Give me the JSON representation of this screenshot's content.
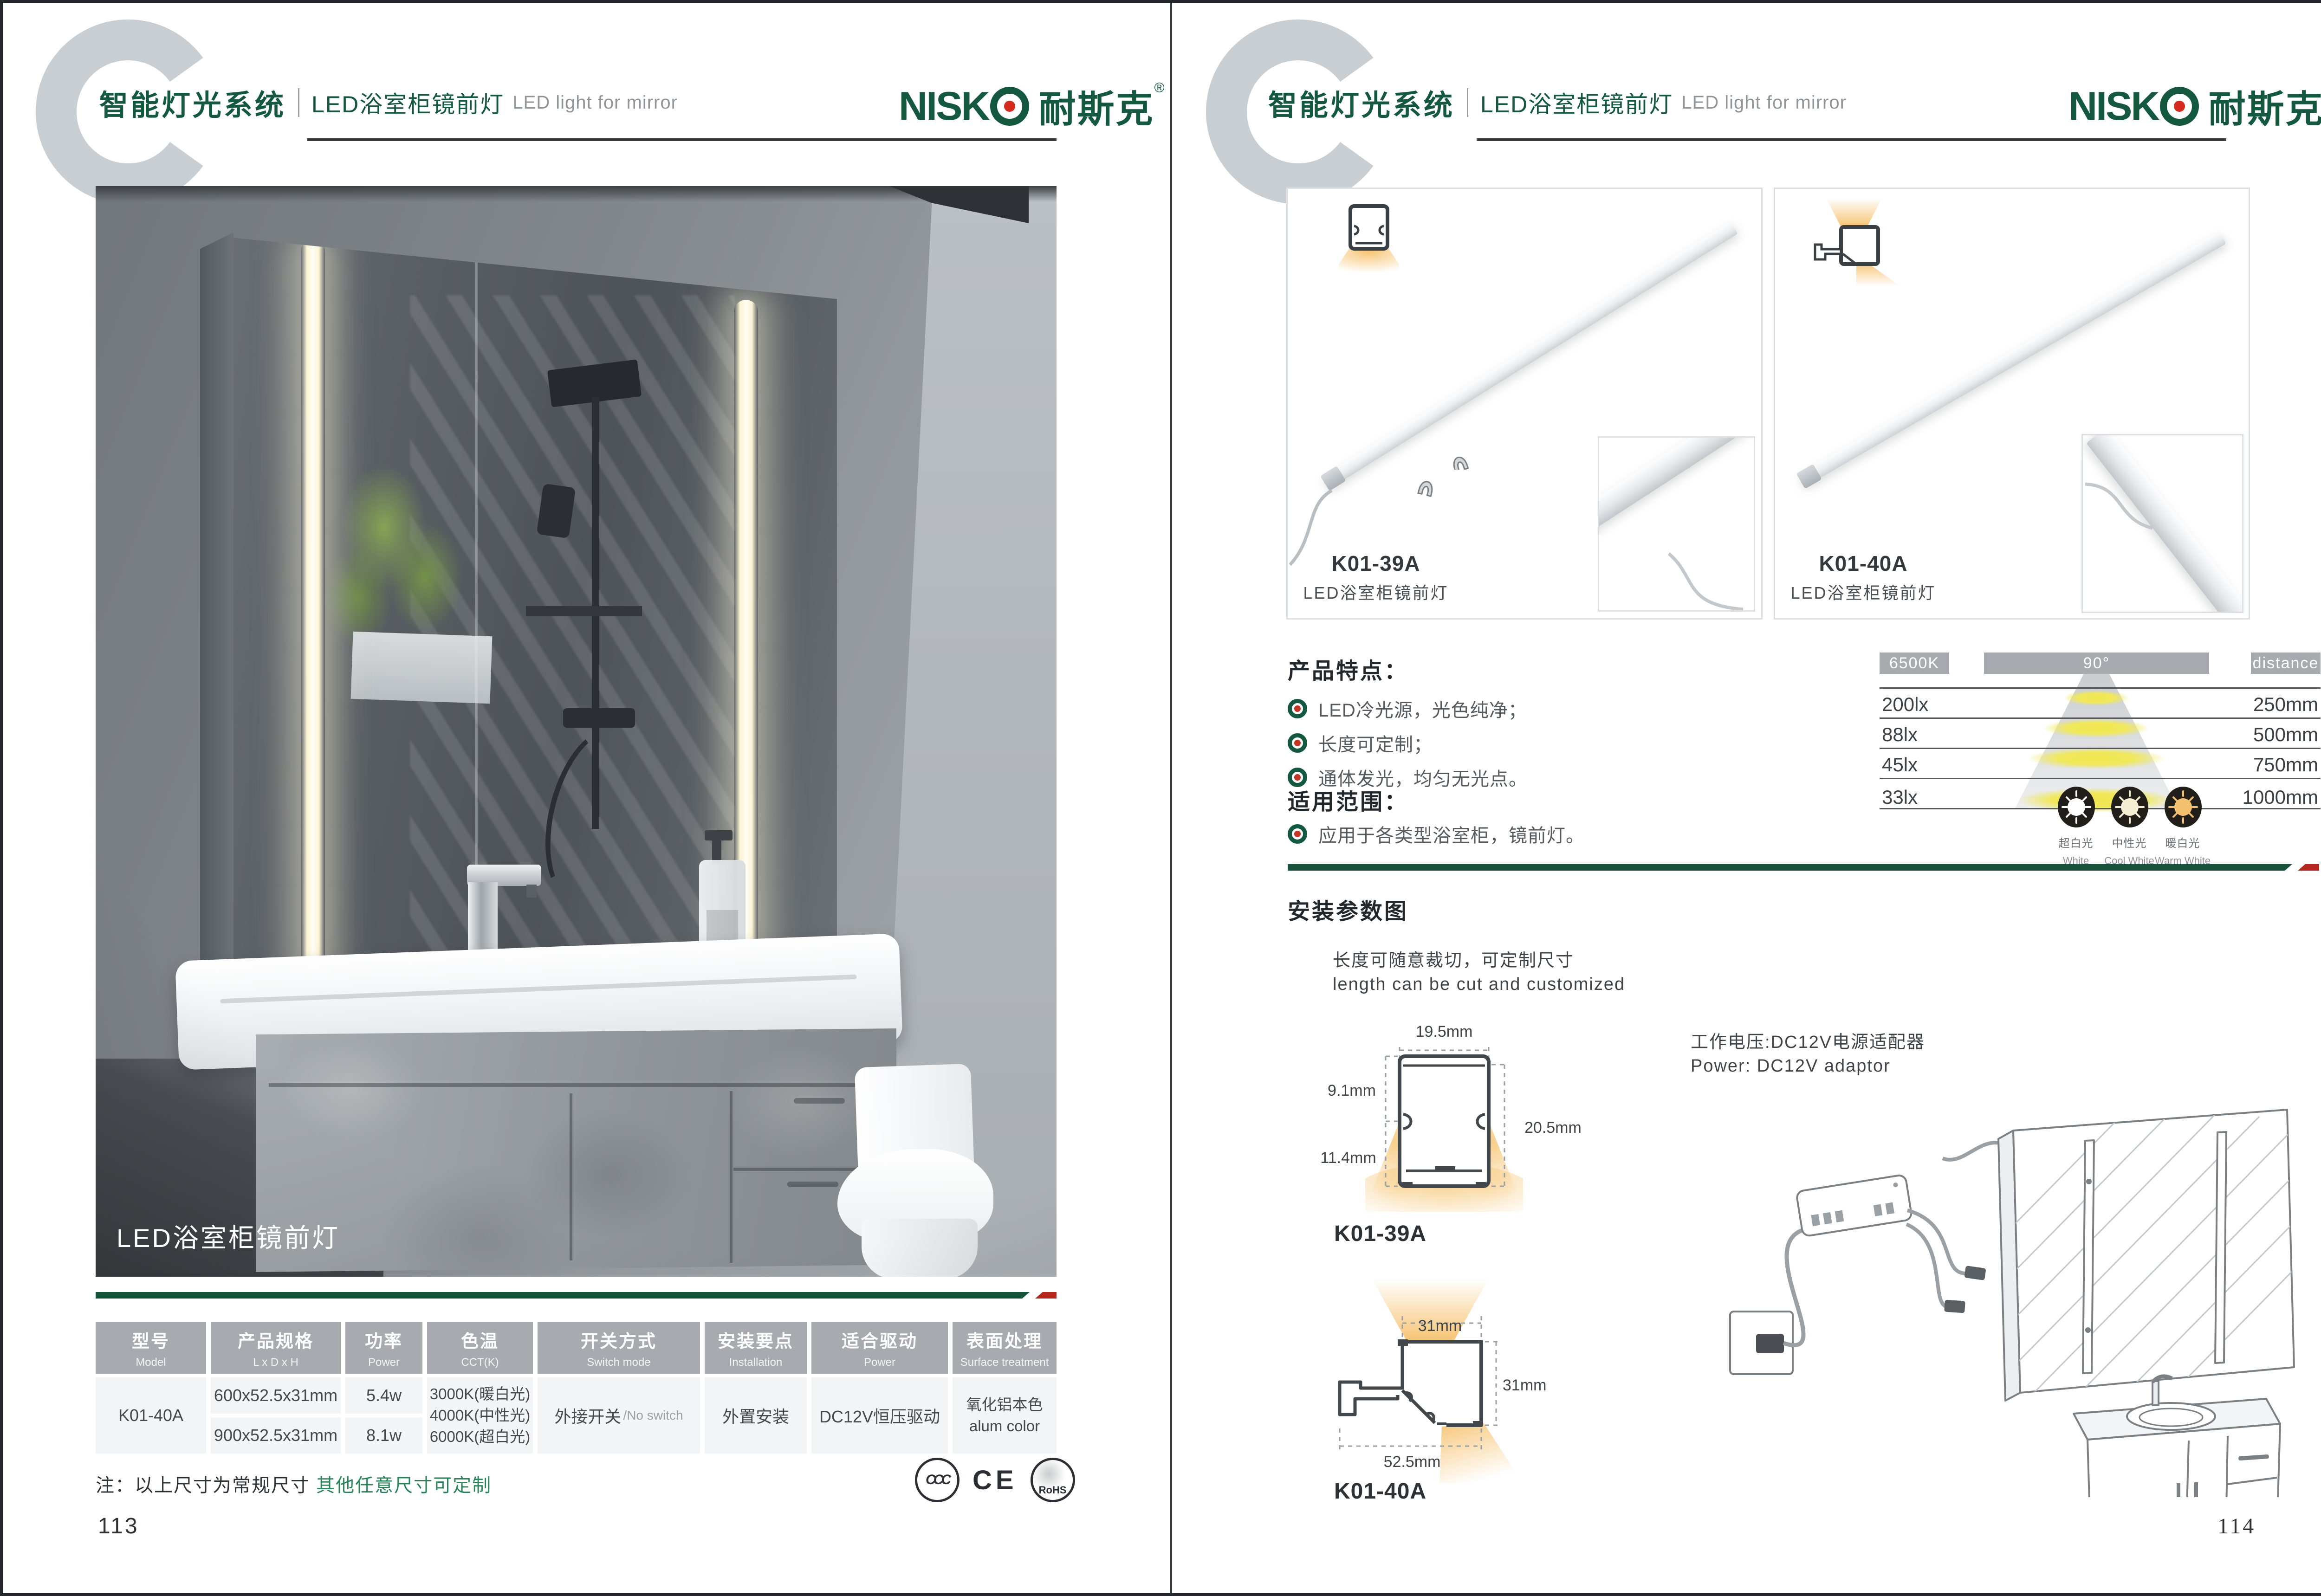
{
  "colors": {
    "brand_green": "#14593F",
    "accent_red": "#B3271E",
    "table_header_gray": "#A7ABAF"
  },
  "header": {
    "section_cn": "智能灯光系统",
    "product_cn": "LED浴室柜镜前灯",
    "product_en": "LED light for mirror",
    "brand_latin": "NISK",
    "brand_cn": "耐斯克",
    "brand_reg": "®"
  },
  "left": {
    "photo_caption": "LED浴室柜镜前灯",
    "table": {
      "headers": [
        {
          "cn": "型号",
          "en": "Model"
        },
        {
          "cn": "产品规格",
          "en": "L x D x H"
        },
        {
          "cn": "功率",
          "en": "Power"
        },
        {
          "cn": "色温",
          "en": "CCT(K)"
        },
        {
          "cn": "开关方式",
          "en": "Switch mode"
        },
        {
          "cn": "安装要点",
          "en": "Installation"
        },
        {
          "cn": "适合驱动",
          "en": "Power"
        },
        {
          "cn": "表面处理",
          "en": "Surface treatment"
        }
      ],
      "model": "K01-40A",
      "spec1": "600x52.5x31mm",
      "spec2": "900x52.5x31mm",
      "power1": "5.4w",
      "power2": "8.1w",
      "cct1": "3000K(暖白光)",
      "cct2": "4000K(中性光)",
      "cct3": "6000K(超白光)",
      "switch_cn": "外接开关",
      "switch_en": "/No switch",
      "install": "外置安装",
      "driver": "DC12V恒压驱动",
      "surface_cn": "氧化铝本色",
      "surface_en": "alum color"
    },
    "note_prefix": "注：以上尺寸为常规尺寸 ",
    "note_green": "其他任意尺寸可定制",
    "cert_ccc": "CCC",
    "cert_ce": "CE",
    "cert_rohs": "RoHS",
    "page_number": "113"
  },
  "right": {
    "product1": {
      "model": "K01-39A",
      "name": "LED浴室柜镜前灯"
    },
    "product2": {
      "model": "K01-40A",
      "name": "LED浴室柜镜前灯"
    },
    "features": {
      "title": "产品特点：",
      "item1": "LED冷光源，光色纯净；",
      "item2": "长度可定制；",
      "item3": "通体发光，均匀无光点。"
    },
    "distribution": {
      "cct": "6500K",
      "angle": "90°",
      "distance": "distance",
      "rows": [
        {
          "lux": "200lx",
          "mm": "250mm"
        },
        {
          "lux": "88lx",
          "mm": "500mm"
        },
        {
          "lux": "45lx",
          "mm": "750mm"
        },
        {
          "lux": "33lx",
          "mm": "1000mm"
        }
      ]
    },
    "colors3": [
      {
        "cn": "超白光",
        "en": "White"
      },
      {
        "cn": "中性光",
        "en": "Cool White"
      },
      {
        "cn": "暖白光",
        "en": "Warm White"
      }
    ],
    "scope": {
      "title": "适用范围：",
      "item1": "应用于各类型浴室柜，镜前灯。"
    },
    "install": {
      "title": "安装参数图",
      "cut_cn": "长度可随意裁切，可定制尺寸",
      "cut_en": "length can be cut and customized",
      "power_cn": "工作电压:DC12V电源适配器",
      "power_en": "Power: DC12V adaptor",
      "p1_model": "K01-39A",
      "p1_w": "19.5mm",
      "p1_h1": "9.1mm",
      "p1_h2": "11.4mm",
      "p1_h": "20.5mm",
      "p2_model": "K01-40A",
      "p2_top": "31mm",
      "p2_right": "31mm",
      "p2_bottom": "52.5mm"
    },
    "page_number": "114"
  }
}
